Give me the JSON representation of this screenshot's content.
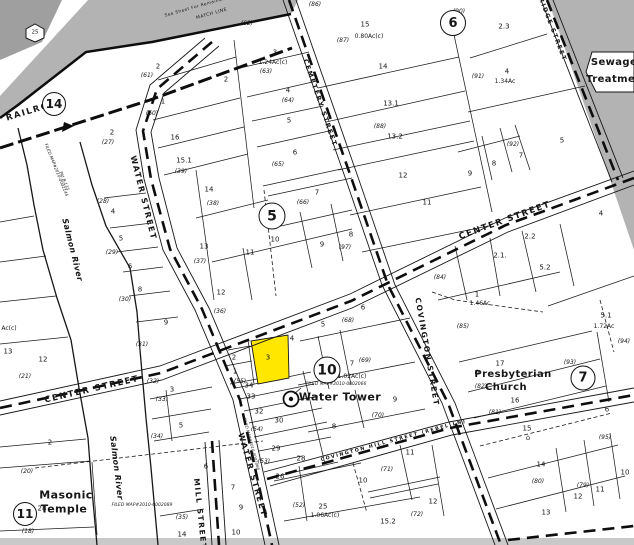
{
  "map": {
    "colors": {
      "highlight_parcel": "#ffe700",
      "offmap_gray": "#b3b3b3",
      "offmap_dark_gray": "#9f9f9f",
      "sheet_edge_gray": "#c9c9c9",
      "line_black": "#161616"
    },
    "circles": [
      {
        "t": "14",
        "x": 54,
        "y": 104,
        "d": 22
      },
      {
        "t": "6",
        "x": 453,
        "y": 23,
        "d": 24
      },
      {
        "t": "5",
        "x": 272,
        "y": 216,
        "d": 25
      },
      {
        "t": "10",
        "x": 327,
        "y": 370,
        "d": 25
      },
      {
        "t": "7",
        "x": 583,
        "y": 378,
        "d": 23
      },
      {
        "t": "11",
        "x": 25,
        "y": 514,
        "d": 22
      }
    ],
    "streets": [
      {
        "t": "RAILROAD",
        "x": 36,
        "y": 110,
        "r": -17,
        "s": 8.5
      },
      {
        "t": "WATER STREET",
        "x": 143,
        "y": 198,
        "r": 76,
        "s": 8
      },
      {
        "t": "WATER STREET",
        "x": 252,
        "y": 475,
        "r": 74,
        "s": 8
      },
      {
        "t": "CENTER STREET",
        "x": 92,
        "y": 390,
        "r": -13,
        "s": 8.5
      },
      {
        "t": "CENTER STREET",
        "x": 505,
        "y": 221,
        "r": -20,
        "s": 8.5
      },
      {
        "t": "COVINGTON STREET",
        "x": 427,
        "y": 352,
        "r": 80,
        "s": 7.5
      },
      {
        "t": "MILL STREET",
        "x": 200,
        "y": 514,
        "r": 84,
        "s": 7.5
      },
      {
        "t": "CEMETERY STREET",
        "x": 320,
        "y": 103,
        "r": 71,
        "s": 6.5
      },
      {
        "t": "BRIDGE STREET",
        "x": 551,
        "y": 27,
        "r": 69,
        "s": 6
      },
      {
        "t": "COVINGTON HILL STREET (REBEL LN)",
        "x": 394,
        "y": 442,
        "r": -15,
        "s": 4.8
      }
    ],
    "features": [
      {
        "t": "Salmon River",
        "x": 72,
        "y": 250,
        "r": 76,
        "s": 8,
        "i": 1,
        "nm": "salmon-river-label"
      },
      {
        "t": "Salmon River",
        "x": 116,
        "y": 468,
        "r": 83,
        "s": 8,
        "i": 1,
        "nm": "salmon-river-label"
      },
      {
        "t": "Water Tower",
        "x": 340,
        "y": 397,
        "s": 11,
        "nm": "water-tower-label"
      },
      {
        "t": "Masonic",
        "x": 66,
        "y": 495,
        "s": 11,
        "nm": "masonic-temple-label"
      },
      {
        "t": "Temple",
        "x": 64,
        "y": 509,
        "s": 11,
        "nm": "masonic-temple-label"
      },
      {
        "t": "Presbyterian",
        "x": 513,
        "y": 375,
        "s": 10,
        "nm": "presbyterian-church-label"
      },
      {
        "t": "Church",
        "x": 506,
        "y": 388,
        "s": 10,
        "nm": "presbyterian-church-label"
      },
      {
        "t": "Sewage",
        "x": 614,
        "y": 63,
        "s": 10,
        "nm": "sewage-treatment-label"
      },
      {
        "t": "Treatment",
        "x": 617,
        "y": 80,
        "s": 10,
        "nm": "sewage-treatment-label"
      }
    ],
    "icons": [
      {
        "t": "25",
        "x": 35,
        "y": 33,
        "s": 5.5,
        "nm": "hexagon-25-label"
      },
      {
        "t": "⌂",
        "x": 477,
        "y": 372,
        "s": 8,
        "nm": "church-icon"
      },
      {
        "t": "⌂",
        "x": 528,
        "y": 438,
        "s": 7,
        "nm": "house-icon"
      }
    ],
    "filed_maps": [
      {
        "t": "FILED MAP#2010-0002144",
        "x": 56,
        "y": 170,
        "r": 68,
        "s": 4.2
      },
      {
        "t": "Pld B-135",
        "x": 64,
        "y": 181,
        "r": 68,
        "s": 4.2
      },
      {
        "t": "FILED MAP#2010-0002066",
        "x": 336,
        "y": 385,
        "s": 4.5
      },
      {
        "t": "FILED MAP#2010-0002066",
        "x": 251,
        "y": 444,
        "r": 75,
        "s": 4
      },
      {
        "t": "FILED MAP#2010-0002089",
        "x": 142,
        "y": 506,
        "s": 4.5
      }
    ],
    "notes": [
      {
        "t": "See Sheet For Remainder",
        "x": 196,
        "y": 7,
        "r": -16,
        "s": 4.2
      },
      {
        "t": "MATCH LINE",
        "x": 212,
        "y": 15,
        "r": -16,
        "s": 4.5
      }
    ],
    "parcels": [
      {
        "t": "2",
        "x": 158,
        "y": 67
      },
      {
        "t": "1",
        "x": 163,
        "y": 102
      },
      {
        "t": "16",
        "x": 175,
        "y": 138
      },
      {
        "t": "15.1",
        "x": 184,
        "y": 161
      },
      {
        "t": "2",
        "x": 112,
        "y": 133
      },
      {
        "t": "2",
        "x": 226,
        "y": 80
      },
      {
        "t": "3",
        "x": 275,
        "y": 53
      },
      {
        "t": "4",
        "x": 288,
        "y": 91
      },
      {
        "t": "5",
        "x": 289,
        "y": 121
      },
      {
        "t": "6",
        "x": 295,
        "y": 153
      },
      {
        "t": "7",
        "x": 317,
        "y": 193
      },
      {
        "t": "15",
        "x": 365,
        "y": 25
      },
      {
        "t": "14",
        "x": 383,
        "y": 67
      },
      {
        "t": "13.1",
        "x": 391,
        "y": 104
      },
      {
        "t": "13.2",
        "x": 395,
        "y": 137
      },
      {
        "t": "12",
        "x": 403,
        "y": 176
      },
      {
        "t": "11",
        "x": 427,
        "y": 203
      },
      {
        "t": "2.3",
        "x": 504,
        "y": 27
      },
      {
        "t": "4",
        "x": 507,
        "y": 72
      },
      {
        "t": "5",
        "x": 562,
        "y": 141
      },
      {
        "t": "7",
        "x": 521,
        "y": 156
      },
      {
        "t": "8",
        "x": 494,
        "y": 164
      },
      {
        "t": "9",
        "x": 470,
        "y": 174
      },
      {
        "t": "2.1.",
        "x": 500,
        "y": 256
      },
      {
        "t": "2.2",
        "x": 530,
        "y": 237
      },
      {
        "t": "4",
        "x": 601,
        "y": 214
      },
      {
        "t": "5.2",
        "x": 545,
        "y": 268
      },
      {
        "t": "1",
        "x": 477,
        "y": 295
      },
      {
        "t": "5.1",
        "x": 606,
        "y": 316
      },
      {
        "t": "14",
        "x": 209,
        "y": 190
      },
      {
        "t": "13",
        "x": 204,
        "y": 247
      },
      {
        "t": "11",
        "x": 250,
        "y": 253
      },
      {
        "t": "10",
        "x": 275,
        "y": 240
      },
      {
        "t": "12",
        "x": 221,
        "y": 293
      },
      {
        "t": "9",
        "x": 322,
        "y": 245
      },
      {
        "t": "8",
        "x": 351,
        "y": 235
      },
      {
        "t": "4",
        "x": 113,
        "y": 212
      },
      {
        "t": "5",
        "x": 121,
        "y": 239
      },
      {
        "t": "6",
        "x": 130,
        "y": 267
      },
      {
        "t": "8",
        "x": 140,
        "y": 290
      },
      {
        "t": "9",
        "x": 166,
        "y": 323
      },
      {
        "t": "12",
        "x": 43,
        "y": 360
      },
      {
        "t": "13",
        "x": 8,
        "y": 352
      },
      {
        "t": "2",
        "x": 50,
        "y": 443
      },
      {
        "t": "28",
        "x": 42,
        "y": 509
      },
      {
        "t": "3",
        "x": 172,
        "y": 390
      },
      {
        "t": "5",
        "x": 181,
        "y": 426
      },
      {
        "t": "6",
        "x": 206,
        "y": 467
      },
      {
        "t": "14",
        "x": 182,
        "y": 535
      },
      {
        "t": "2",
        "x": 234,
        "y": 358
      },
      {
        "t": "1",
        "x": 235,
        "y": 372
      },
      {
        "t": "3",
        "x": 268,
        "y": 358
      },
      {
        "t": "34",
        "x": 249,
        "y": 386
      },
      {
        "t": "33",
        "x": 251,
        "y": 397
      },
      {
        "t": "32",
        "x": 259,
        "y": 412
      },
      {
        "t": "30",
        "x": 279,
        "y": 421
      },
      {
        "t": "29",
        "x": 276,
        "y": 449
      },
      {
        "t": "28",
        "x": 301,
        "y": 459
      },
      {
        "t": "26",
        "x": 280,
        "y": 477
      },
      {
        "t": "25",
        "x": 323,
        "y": 507
      },
      {
        "t": "7",
        "x": 233,
        "y": 488
      },
      {
        "t": "9",
        "x": 241,
        "y": 508
      },
      {
        "t": "10",
        "x": 236,
        "y": 533
      },
      {
        "t": "4",
        "x": 292,
        "y": 339
      },
      {
        "t": "5",
        "x": 323,
        "y": 325
      },
      {
        "t": "6",
        "x": 363,
        "y": 308
      },
      {
        "t": "7",
        "x": 352,
        "y": 364
      },
      {
        "t": "9",
        "x": 395,
        "y": 400
      },
      {
        "t": "8",
        "x": 334,
        "y": 427
      },
      {
        "t": "10",
        "x": 363,
        "y": 481
      },
      {
        "t": "11",
        "x": 410,
        "y": 453
      },
      {
        "t": "15.2",
        "x": 388,
        "y": 522
      },
      {
        "t": "17",
        "x": 500,
        "y": 364
      },
      {
        "t": "16",
        "x": 515,
        "y": 401
      },
      {
        "t": "15",
        "x": 527,
        "y": 429
      },
      {
        "t": "14",
        "x": 541,
        "y": 465
      },
      {
        "t": "13",
        "x": 546,
        "y": 513
      },
      {
        "t": "12",
        "x": 578,
        "y": 497
      },
      {
        "t": "12",
        "x": 433,
        "y": 502
      },
      {
        "t": "11",
        "x": 600,
        "y": 490
      },
      {
        "t": "10",
        "x": 625,
        "y": 473
      },
      {
        "t": "6",
        "x": 607,
        "y": 410
      }
    ],
    "refs": [
      {
        "t": "(61)",
        "x": 147,
        "y": 76
      },
      {
        "t": "(60)",
        "x": 152,
        "y": 114
      },
      {
        "t": "(39)",
        "x": 181,
        "y": 172
      },
      {
        "t": "(27)",
        "x": 108,
        "y": 143
      },
      {
        "t": "(62)",
        "x": 247,
        "y": 24
      },
      {
        "t": "(63)",
        "x": 266,
        "y": 72
      },
      {
        "t": "(64)",
        "x": 288,
        "y": 101
      },
      {
        "t": "(65)",
        "x": 278,
        "y": 165
      },
      {
        "t": "(66)",
        "x": 303,
        "y": 203
      },
      {
        "t": "(86)",
        "x": 315,
        "y": 5
      },
      {
        "t": "(87)",
        "x": 343,
        "y": 41
      },
      {
        "t": "(88)",
        "x": 380,
        "y": 127
      },
      {
        "t": "(90)",
        "x": 459,
        "y": 12
      },
      {
        "t": "(91)",
        "x": 478,
        "y": 77
      },
      {
        "t": "(92)",
        "x": 513,
        "y": 145
      },
      {
        "t": "(84)",
        "x": 440,
        "y": 278
      },
      {
        "t": "(85)",
        "x": 463,
        "y": 327
      },
      {
        "t": "(94)",
        "x": 624,
        "y": 342
      },
      {
        "t": "(38)",
        "x": 213,
        "y": 204
      },
      {
        "t": "(37)",
        "x": 200,
        "y": 262
      },
      {
        "t": "(36)",
        "x": 220,
        "y": 312
      },
      {
        "t": "(97)",
        "x": 345,
        "y": 248
      },
      {
        "t": "(28)",
        "x": 103,
        "y": 202
      },
      {
        "t": "(29)",
        "x": 112,
        "y": 253
      },
      {
        "t": "(30)",
        "x": 125,
        "y": 300
      },
      {
        "t": "(21)",
        "x": 25,
        "y": 377
      },
      {
        "t": "(20)",
        "x": 27,
        "y": 472
      },
      {
        "t": "(18)",
        "x": 28,
        "y": 532
      },
      {
        "t": "(31)",
        "x": 142,
        "y": 345
      },
      {
        "t": "(32)",
        "x": 153,
        "y": 382
      },
      {
        "t": "(33)",
        "x": 162,
        "y": 400
      },
      {
        "t": "(34)",
        "x": 157,
        "y": 437
      },
      {
        "t": "(35)",
        "x": 182,
        "y": 518
      },
      {
        "t": "(55)",
        "x": 240,
        "y": 382
      },
      {
        "t": "(54)",
        "x": 257,
        "y": 430
      },
      {
        "t": "(53)",
        "x": 264,
        "y": 462
      },
      {
        "t": "(52)",
        "x": 299,
        "y": 506
      },
      {
        "t": "(68)",
        "x": 348,
        "y": 321
      },
      {
        "t": "(69)",
        "x": 365,
        "y": 361
      },
      {
        "t": "(70)",
        "x": 378,
        "y": 416
      },
      {
        "t": "(71)",
        "x": 387,
        "y": 470
      },
      {
        "t": "(72)",
        "x": 417,
        "y": 515
      },
      {
        "t": "(79)",
        "x": 583,
        "y": 486
      },
      {
        "t": "(80)",
        "x": 538,
        "y": 482
      },
      {
        "t": "(81)",
        "x": 495,
        "y": 413
      },
      {
        "t": "(82)",
        "x": 481,
        "y": 387
      },
      {
        "t": "(93)",
        "x": 570,
        "y": 363
      },
      {
        "t": "(95)",
        "x": 605,
        "y": 438
      }
    ],
    "areas": [
      {
        "t": "1.24Ac(c)",
        "x": 273,
        "y": 63
      },
      {
        "t": "0.80Ac(c)",
        "x": 369,
        "y": 37
      },
      {
        "t": "1.34Ac",
        "x": 505,
        "y": 82
      },
      {
        "t": "1.46Ac",
        "x": 480,
        "y": 304
      },
      {
        "t": "1.72Ac",
        "x": 604,
        "y": 327
      },
      {
        "t": "1.02Ac(c)",
        "x": 352,
        "y": 377
      },
      {
        "t": "1.06Ac(c)",
        "x": 325,
        "y": 516
      },
      {
        "t": "Ac(c)",
        "x": 9,
        "y": 329
      }
    ]
  }
}
